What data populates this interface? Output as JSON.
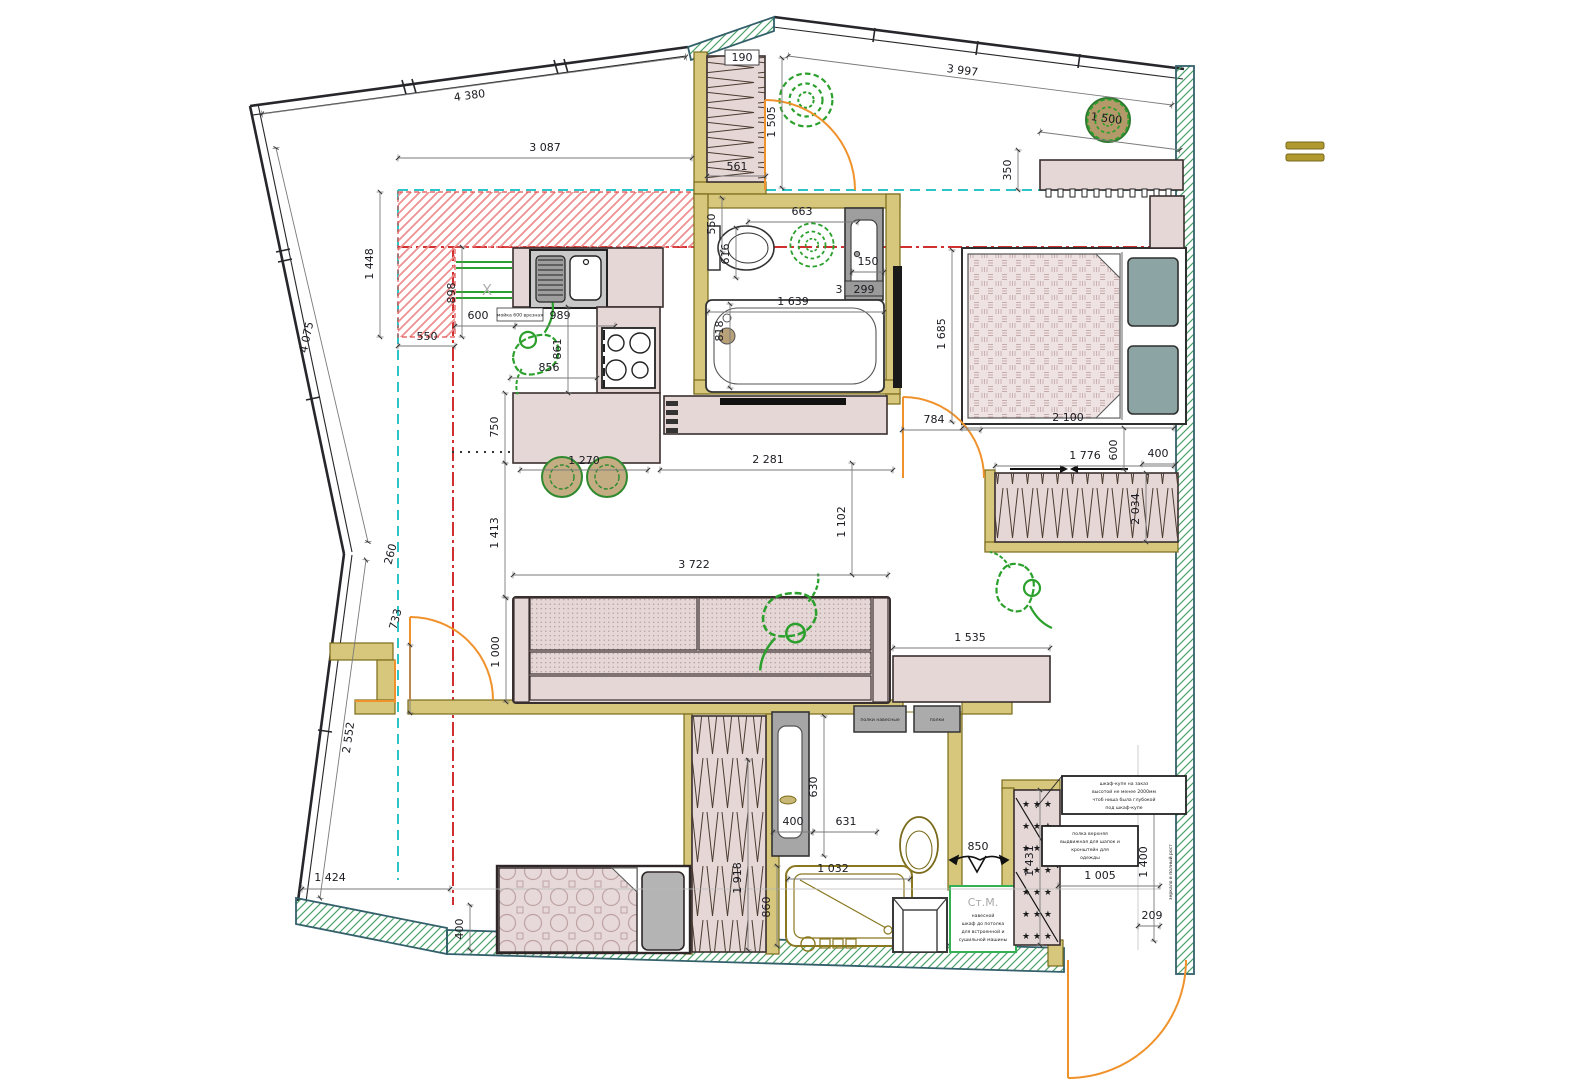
{
  "dims": {
    "top_wall_left": "4 380",
    "kitchen_front": "3 087",
    "top_wall_right": "3 997",
    "desk_width": "1 500",
    "desk_depth": "350",
    "hall_closet_height": "1 505",
    "hall_closet_top": "190",
    "hall_closet_width": "561",
    "kitchen_zone_height": "1 448",
    "left_wall_upper": "4 075",
    "kitchen_zone_leg": "550",
    "fridge_niche_depth": "898",
    "fridge_niche_width": "600",
    "counter_span": "989",
    "hob_counter_depth": "861",
    "hob_counter_width": "856",
    "island_depth": "750",
    "island_width": "1 270",
    "island_sofa_gap": "1 413",
    "sofa_width": "3 722",
    "sofa_wall_gap": "1 102",
    "sofa_depth": "1 000",
    "balcony_jamb": "733",
    "balcony_gap": "260",
    "left_wall_lower": "2 552",
    "bottom_left_span": "1 424",
    "daybed_offset": "400",
    "wc_offset": "550",
    "wc_width": "616",
    "wc_side_gap": "663",
    "bath_shelf_offset": "150",
    "bath_shelf_width": "299",
    "bath_shelf_extra": "3",
    "bathtub_length": "1 639",
    "bathtub_width": "818",
    "living_span": "2 281",
    "bedroom_door_width": "784",
    "bedroom_depth": "1 685",
    "bed_length": "2 100",
    "bed_side_gap": "600",
    "bedroom_wardrobe_width": "1 776",
    "bedroom_wardrobe_end": "400",
    "bedroom_wardrobe_length": "2 034",
    "console_width": "1 535",
    "bath2_cabinet_height": "630",
    "bath2_cabinet_width": "400",
    "bath2_span": "631",
    "shower_width": "1 032",
    "shower_depth": "860",
    "hall_wardrobe_height": "1 918",
    "extractor_width": "850",
    "entry_niche_height": "1 431",
    "entry_width": "1 005",
    "entry_height": "1 400",
    "entry_offset": "209"
  },
  "labels": {
    "washing_machine": "Ст.М.",
    "x_mark": "X",
    "shaft_row": "★ ★ ★"
  },
  "notes": {
    "entry_upper_1": "шкаф-купе на заказ",
    "entry_upper_2": "высотой не менее 2000мм",
    "entry_upper_3": "чтоб ниша была глубокой",
    "entry_upper_4": "под шкаф-купе",
    "entry_lower_1": "полка верхняя",
    "entry_lower_2": "выдвижная для шапок и",
    "entry_lower_3": "кронштейн для",
    "entry_lower_4": "одежды",
    "stm_1": "навесной",
    "stm_2": "шкаф до потолка",
    "stm_3": "для встроенной и",
    "stm_4": "сушильной машины",
    "shelf_left": "полки навесные",
    "shelf_right": "полки",
    "sink_note": "мойка 600 врезная",
    "right_wall_note": "зеркало в полный рост"
  }
}
